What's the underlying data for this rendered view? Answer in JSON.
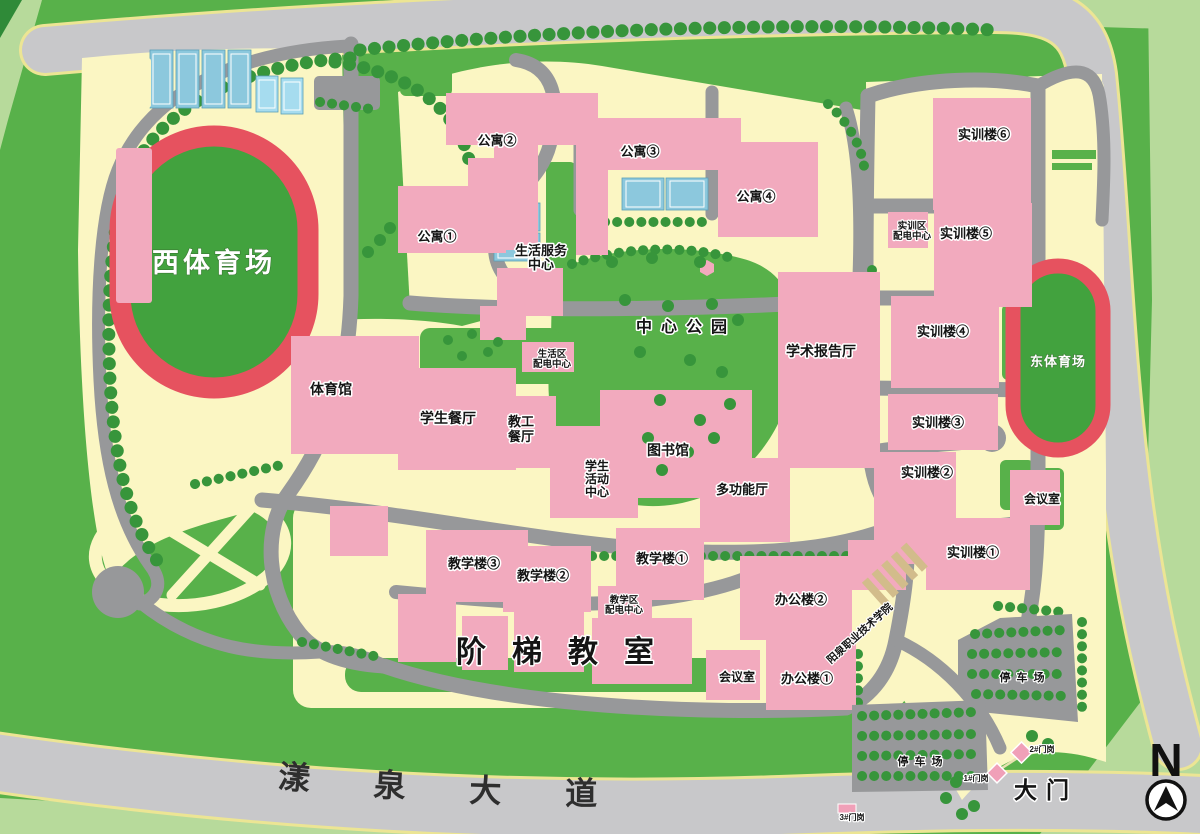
{
  "palette": {
    "grass_green": "#58b14a",
    "light_green": "#b7da9b",
    "campus_yellow": "#fbf6c3",
    "road_dark_gray": "#97989a",
    "road_light_gray": "#c8c8ca",
    "building_pink": "#f2aabe",
    "track_red": "#e6525f",
    "infield_green": "#42a23e",
    "court_blue": "#8cc8dd",
    "tree_green": "#37953b"
  },
  "compass": {
    "letter": "N"
  },
  "avenue": {
    "name": "漾泉大道"
  },
  "areas": {
    "west_stadium": "西体育场",
    "east_stadium": "东体育场",
    "central_park": "中心公园",
    "tiered_classrooms": "阶梯教室",
    "main_gate": "大门",
    "parking_right": "停车场",
    "parking_bottom": "停车场",
    "college_name": "阳泉职业技术学院"
  },
  "buildings": {
    "apartment_1": "公寓①",
    "apartment_2": "公寓②",
    "apartment_3": "公寓③",
    "apartment_4": "公寓④",
    "life_service_center": {
      "line1": "生活服务",
      "line2": "中心"
    },
    "life_power": {
      "line1": "生活区",
      "line2": "配电中心"
    },
    "academic_hall": "学术报告厅",
    "gymnasium": "体育馆",
    "student_dining": "学生餐厅",
    "staff_dining": {
      "line1": "教工",
      "line2": "餐厅"
    },
    "library": "图书馆",
    "student_center": {
      "line1": "学生",
      "line2": "活动",
      "line3": "中心"
    },
    "multi_hall": "多功能厅",
    "training_1": "实训楼①",
    "training_2": "实训楼②",
    "training_3": "实训楼③",
    "training_4": "实训楼④",
    "training_5": "实训楼⑤",
    "training_6": "实训楼⑥",
    "training_power": {
      "line1": "实训区",
      "line2": "配电中心"
    },
    "teaching_1": "教学楼①",
    "teaching_2": "教学楼②",
    "teaching_3": "教学楼③",
    "teaching_power": {
      "line1": "教学区",
      "line2": "配电中心"
    },
    "office_1": "办公楼①",
    "office_2": "办公楼②",
    "meeting_room_right": "会议室",
    "meeting_room_bottom": "会议室"
  },
  "gates": {
    "gate_1": "1#门岗",
    "gate_2": "2#门岗",
    "gate_3": "3#门岗"
  }
}
